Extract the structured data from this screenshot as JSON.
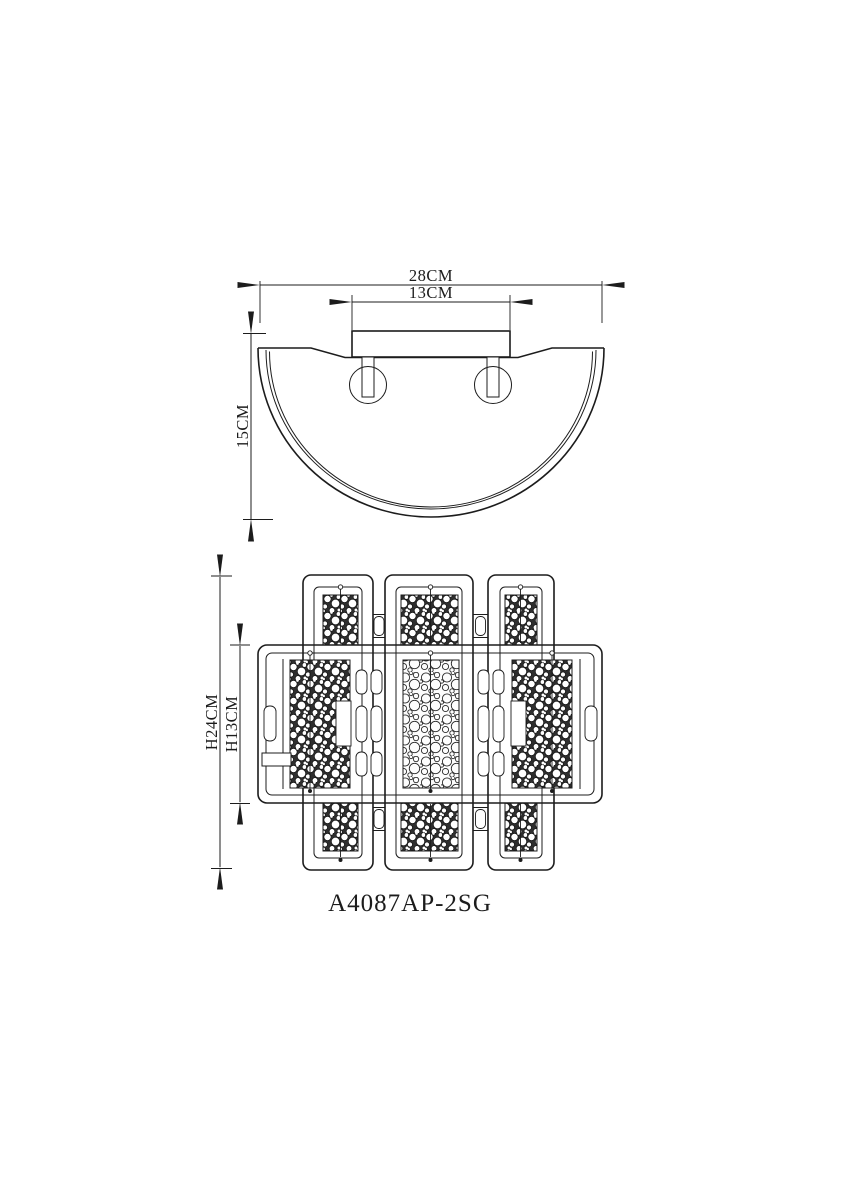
{
  "colors": {
    "background": "#ffffff",
    "line": "#1c1c1c"
  },
  "side_view": {
    "width_total_label": "28CM",
    "width_canopy_label": "13CM",
    "height_label": "15CM"
  },
  "front_view": {
    "height_total_label": "H24CM",
    "height_shade_label": "H13CM"
  },
  "model_label": "A4087AP-2SG"
}
